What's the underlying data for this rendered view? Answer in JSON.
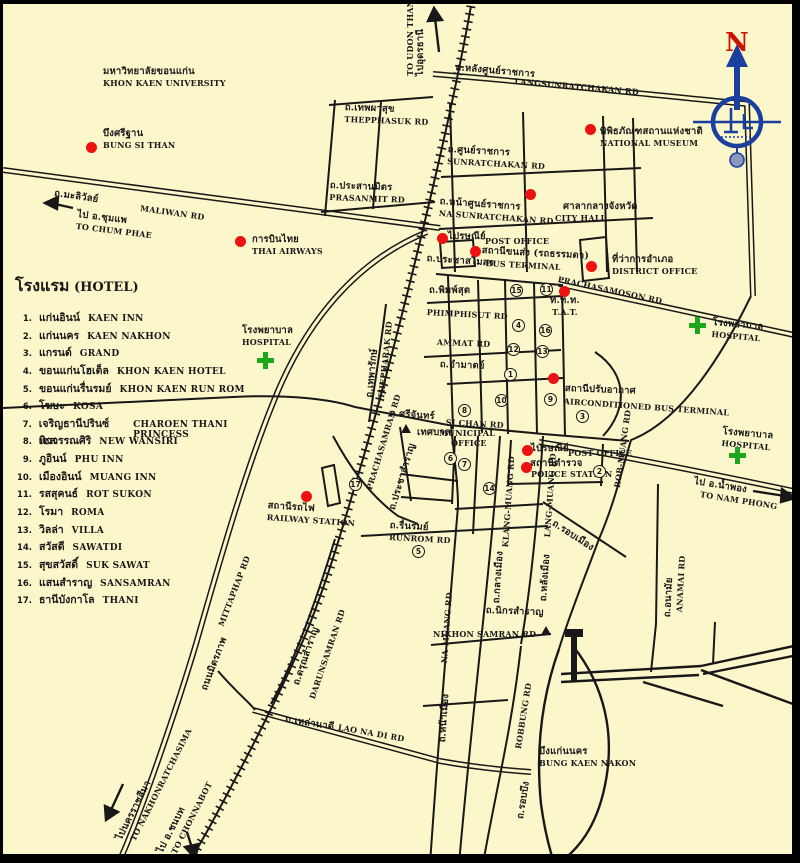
{
  "legend": {
    "title_th": "โรงแรม",
    "title_en": "(HOTEL)",
    "items": [
      {
        "num": "1.",
        "thai": "แก่นอินน์",
        "eng": "KAEN INN"
      },
      {
        "num": "2.",
        "thai": "แก่นนคร",
        "eng": "KAEN NAKHON"
      },
      {
        "num": "3.",
        "thai": "แกรนด์",
        "eng": "GRAND"
      },
      {
        "num": "4.",
        "thai": "ขอนแก่นโฮเต็ล",
        "eng": "KHON KAEN HOTEL"
      },
      {
        "num": "5.",
        "thai": "ขอนแก่นรื่นรมย์",
        "eng": "KHON KAEN RUN ROM"
      },
      {
        "num": "6.",
        "thai": "โฆษะ",
        "eng": "KOSA"
      },
      {
        "num": "7.",
        "thai": "เจริญธานีปรินซ์เซส",
        "eng": "CHAROEN THANI PRINCESS"
      },
      {
        "num": "8.",
        "thai": "นิววรรณศิริ",
        "eng": "NEW WANSIRI"
      },
      {
        "num": "9.",
        "thai": "ภูอินน์",
        "eng": "PHU INN"
      },
      {
        "num": "10.",
        "thai": "เมืองอินน์",
        "eng": "MUANG INN"
      },
      {
        "num": "11.",
        "thai": "รสสุคนธ์",
        "eng": "ROT SUKON"
      },
      {
        "num": "12.",
        "thai": "โรมา",
        "eng": "ROMA"
      },
      {
        "num": "13.",
        "thai": "วิลล่า",
        "eng": "VILLA"
      },
      {
        "num": "14.",
        "thai": "สวัสดี",
        "eng": "SAWATDI"
      },
      {
        "num": "15.",
        "thai": "สุขสวัสดิ์",
        "eng": "SUK SAWAT"
      },
      {
        "num": "16.",
        "thai": "แสนสำราญ",
        "eng": "SANSAMRAN"
      },
      {
        "num": "17.",
        "thai": "ธานีบังกาโล",
        "eng": "THANI"
      }
    ]
  },
  "places": {
    "university": {
      "th": "มหาวิทยาลัยขอนแก่น",
      "en": "KHON KAEN UNIVERSITY"
    },
    "bung_si_than": {
      "th": "บึงศรีฐาน",
      "en": "BUNG SI THAN"
    },
    "thai_airways": {
      "th": "การบินไทย",
      "en": "THAI AIRWAYS"
    },
    "national_museum": {
      "th": "พิพิธภัณฑสถานแห่งชาติ",
      "en": "NATIONAL MUSEUM"
    },
    "city_hall": {
      "th": "ศาลากลางจังหวัด",
      "en": "CITY HALL"
    },
    "post_office_n": {
      "th": "ไปรษณีย์",
      "en": "POST OFFICE"
    },
    "bus_terminal": {
      "th": "สถานีขนส่ง (รถธรรมดา)",
      "en": "BUS TERMINAL"
    },
    "district_office": {
      "th": "ที่ว่าการอำเภอ",
      "en": "DISTRICT  OFFICE"
    },
    "tat": {
      "th": "ท.ท.ท.",
      "en": "T.A.T."
    },
    "hospital": {
      "th": "โรงพยาบาล",
      "en": "HOSPITAL"
    },
    "ac_bus_terminal": {
      "th": "สถานีปรับอากาศ",
      "en": "AIRCONDITIONED BUS TERMINAL"
    },
    "municipal": {
      "th": "เทศบาล",
      "en1": "MUNICIPAL",
      "en2": "OFFICE"
    },
    "post_office_s": {
      "th": "ไปรษณีย์",
      "en": "POST OFFICE"
    },
    "police_station": {
      "th": "สถานีตำรวจ",
      "en": "POLICE STATION"
    },
    "railway_station": {
      "th": "สถานีรถไฟ",
      "en": "RAILWAY STATION"
    },
    "bung_kaen_nakon": {
      "th": "บึงแก่นนคร",
      "en": "BUNG KAEN NAKON"
    }
  },
  "roads": {
    "maliwan": {
      "th": "ถ.มะลิวัลย์",
      "en": "MALIWAN RD"
    },
    "thepphasuk": {
      "th": "ถ.เทพผาสุข",
      "en": "THEPPHASUK RD"
    },
    "prasanmit": {
      "th": "ถ.ประสานมิตร",
      "en": "PRASANMIT RD"
    },
    "langsunratchakan": {
      "th": "ถ.หลังศูนย์ราชการ",
      "en": "LANGSUNRATCHAKAN RD"
    },
    "sunratchakan": {
      "th": "ถ.ศูนย์ราชการ",
      "en": "SUNRATCHAKAN RD"
    },
    "na_sunratchakan": {
      "th": "ถ.หน้าศูนย์ราชการ",
      "en": "NA SUNRATCHAKAN RD"
    },
    "prachasamoson": {
      "th": "ถ.ประชาสโมสร",
      "en": "PRACHASAMOSON RD"
    },
    "phimphisut": {
      "th": "ถ.พิมพ์สุต",
      "en": "PHIMPHISUT RD"
    },
    "ammat": {
      "th": "ถ.อำมาตย์",
      "en": "AMMAT RD"
    },
    "si_chan": {
      "th": "ถ.ศรีจันทร์",
      "en": "SI CHAN RD"
    },
    "thepharak": {
      "th": "ถ.เทพารักษ์",
      "en": "THEPHARAK RD"
    },
    "prachasamran": {
      "th": "ถ.ประชาสำราญ",
      "en": "PRACHASAMRAN RD"
    },
    "rob_muang": {
      "th": "ถ.รอบเมือง",
      "en": "ROB-MUANG RD"
    },
    "klang_muang": {
      "th": "ถ.กลางเมือง",
      "en": "KLANG-MUANG RD"
    },
    "lang_muang": {
      "th": "ถ.หลังเมือง",
      "en": "LANG-MUANG RD"
    },
    "na_muang": {
      "th": "ถ.หน้าเมือง",
      "en": "NA-MUANG RD"
    },
    "runrom": {
      "th": "ถ.รื่นรมย์",
      "en": "RUNROM RD"
    },
    "nikhon_samran": {
      "th": "ถ.นิกรสำราญ",
      "en": "NIKHON SAMRAN RD"
    },
    "darunsamran": {
      "th": "ถ.ดรุณสำราญ",
      "en": "DARUNSAMRAN RD"
    },
    "lao_na_di": {
      "th": "ถ.เหล่านาดี",
      "en": "LAO NA DI RD"
    },
    "mittaphap": {
      "th": "ถนนมิตรภาพ",
      "en": "MITTAPHAP RD"
    },
    "robbung": {
      "th": "ถ.รอบบึง",
      "en": "ROBBUNG RD"
    },
    "anamai": {
      "th": "ถ.อนามัย",
      "en": "ANAMAI RD"
    }
  },
  "directions": {
    "to_chum_phae": {
      "th": "ไป อ.ชุมแพ",
      "en": "TO CHUM PHAE"
    },
    "to_udon_thani": {
      "th": "ไปอุดรธานี",
      "en": "TO UDON THANI"
    },
    "to_nam_phong": {
      "th": "ไป อ.น้ำพอง",
      "en": "TO NAM PHONG"
    },
    "to_nakhonratchasima": {
      "th": "ไปนครราชสีมา",
      "en": "TO NAKHONRATCHASIMA"
    },
    "to_chonnabot": {
      "th": "ไป อ.ชนบท",
      "en": "TO CHONNABOT"
    }
  },
  "compass": {
    "north": "N"
  },
  "map_circles": [
    {
      "n": "15"
    },
    {
      "n": "11"
    },
    {
      "n": "4"
    },
    {
      "n": "16"
    },
    {
      "n": "12"
    },
    {
      "n": "13"
    },
    {
      "n": "1"
    },
    {
      "n": "10"
    },
    {
      "n": "9"
    },
    {
      "n": "8"
    },
    {
      "n": "3"
    },
    {
      "n": "6"
    },
    {
      "n": "7"
    },
    {
      "n": "2"
    },
    {
      "n": "14"
    },
    {
      "n": "5"
    },
    {
      "n": "17"
    }
  ],
  "colors": {
    "background": "#FBF7CB",
    "ink": "#181818",
    "marker_red": "#EE1111",
    "hospital_green": "#1CA81C",
    "compass_blue": "#1A3F9E",
    "north_red": "#CC1100"
  }
}
